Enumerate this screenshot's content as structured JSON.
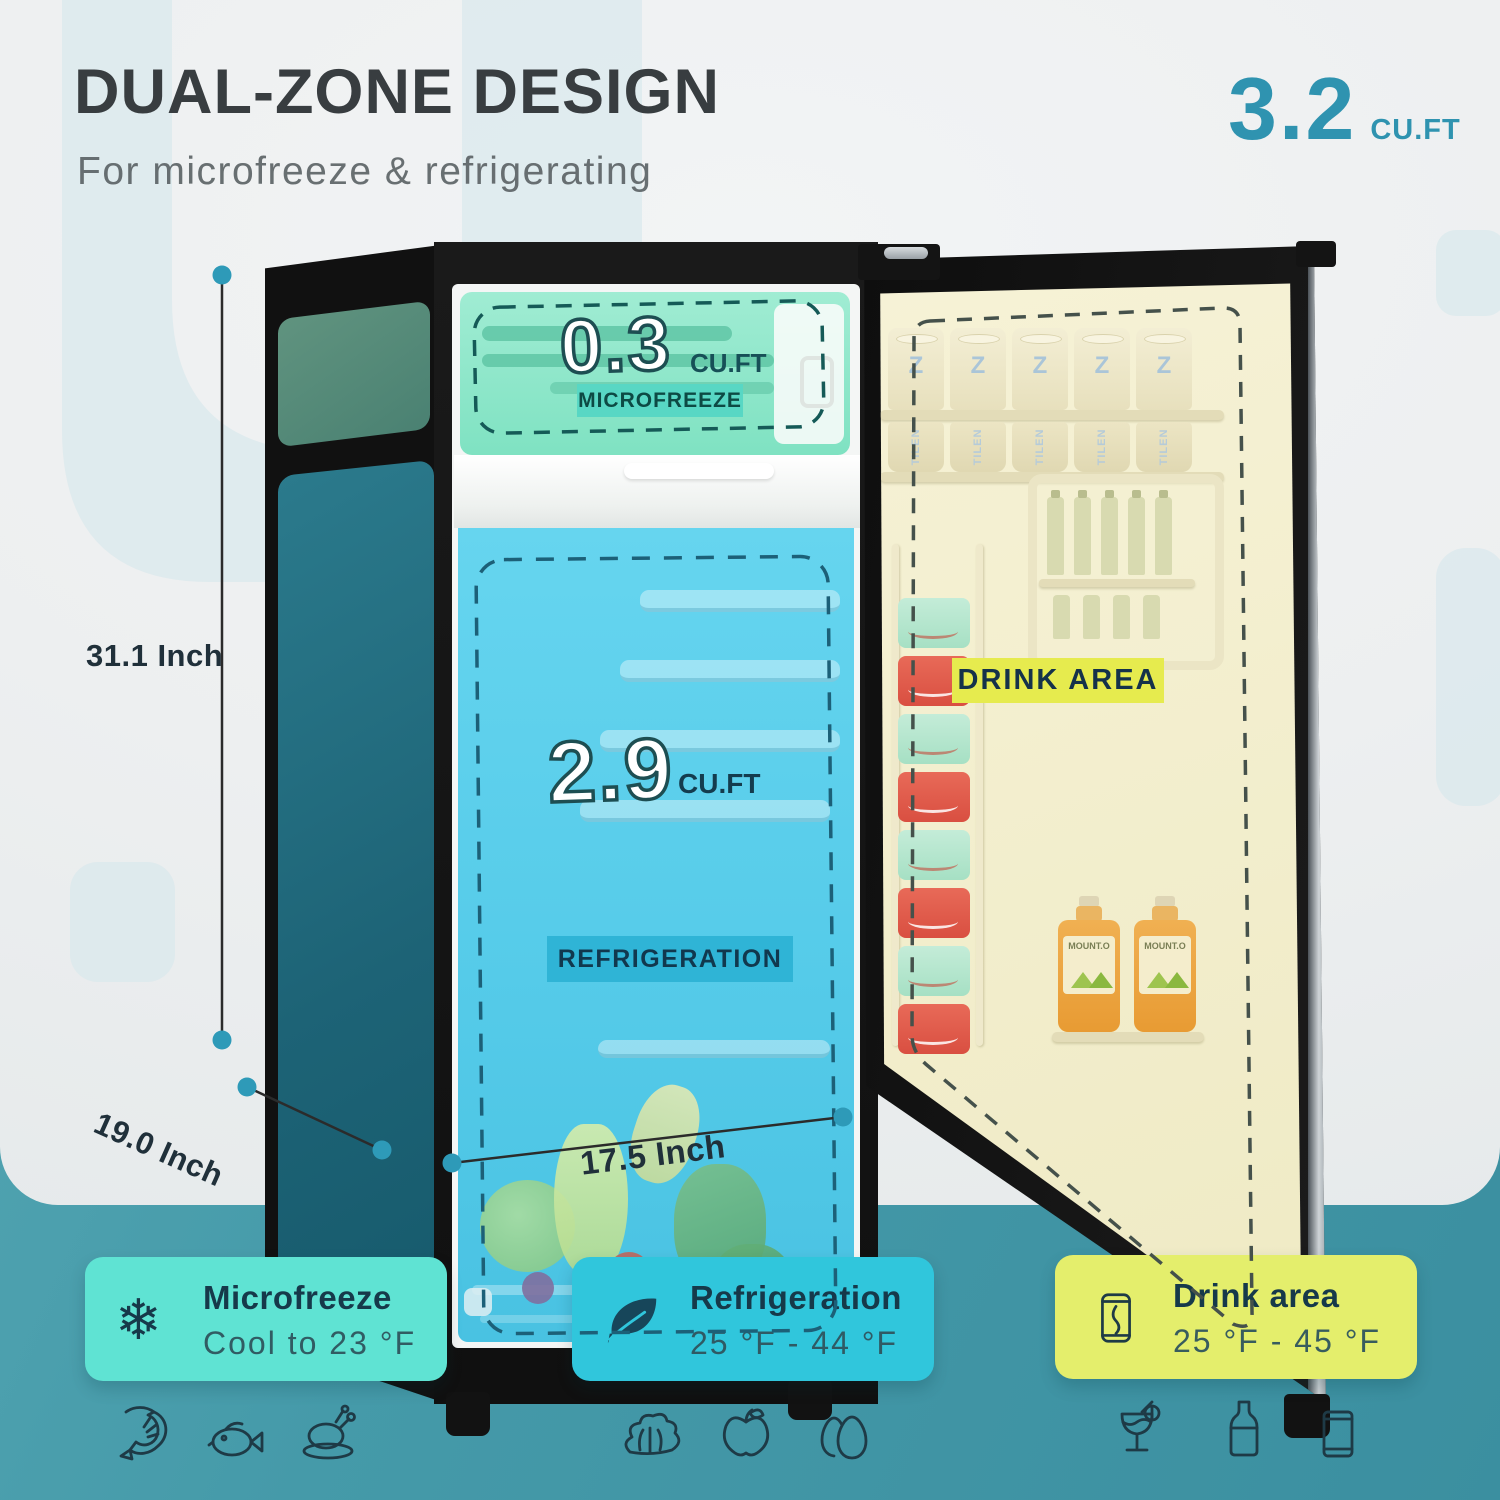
{
  "header": {
    "title": "DUAL-ZONE DESIGN",
    "subtitle": "For microfreeze & refrigerating",
    "capacity": {
      "value": "3.2",
      "unit": "CU.FT"
    }
  },
  "fridge": {
    "freezer": {
      "value": "0.3",
      "unit": "CU.FT",
      "label": "MICROFREEZE"
    },
    "fresh": {
      "value": "2.9",
      "unit": "CU.FT",
      "label": "REFRIGERATION"
    },
    "door": {
      "label": "DRINK AREA",
      "can_brand": "TILEN",
      "can_mark": "Z",
      "juice_label": "MOUNT.O"
    },
    "dimensions": {
      "height": "31.1 Inch",
      "depth": "19.0 Inch",
      "width": "17.5 Inch"
    }
  },
  "cards": [
    {
      "icon": "snowflake-icon",
      "title": "Microfreeze",
      "subtitle": "Cool to 23 °F",
      "bg": "#5fe3d3"
    },
    {
      "icon": "leaf-icon",
      "title": "Refrigeration",
      "subtitle": "25 °F - 44 °F",
      "bg": "#30c6dc"
    },
    {
      "icon": "drink-can-icon",
      "title": "Drink area",
      "subtitle": "25 °F - 45 °F",
      "bg": "#e4ee6c"
    }
  ],
  "food_icons": {
    "freezer": [
      "shrimp-icon",
      "fish-icon",
      "roast-chicken-icon"
    ],
    "fresh": [
      "lettuce-icon",
      "apple-icon",
      "eggs-icon"
    ],
    "drinks": [
      "cocktail-icon",
      "bottle-icon",
      "beverage-can-icon"
    ]
  },
  "icons": {
    "snowflake_glyph": "❄"
  },
  "colors": {
    "accent_teal": "#2f93b0",
    "band_teal": "#459aa9",
    "freezer_zone": "#93e9cf",
    "fresh_zone": "#5bcfeb",
    "door_liner": "#f4f0cf",
    "drink_chip": "#e6eb4e",
    "cabinet_black": "#151515",
    "side_panel_teal": "#1f6b7c"
  }
}
